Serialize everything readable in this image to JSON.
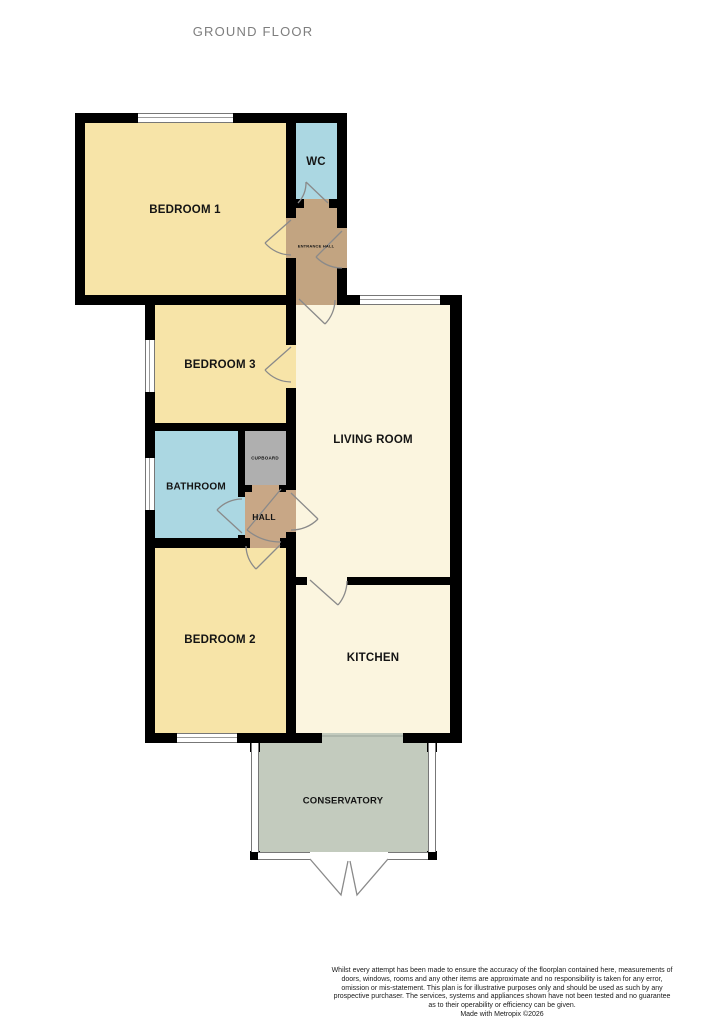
{
  "title": "GROUND FLOOR",
  "colors": {
    "bedroom": "#F7E4A8",
    "cream": "#FBF5DF",
    "wet": "#ABD7E2",
    "entrance": "#C2A481",
    "hall": "#C8A786",
    "cupboard": "#AFAFAF",
    "conservatory": "#C3CBBE",
    "wall": "#000000",
    "white": "#FFFFFF"
  },
  "rooms": {
    "bedroom1": {
      "label": "BEDROOM 1"
    },
    "wc": {
      "label": "WC"
    },
    "entrance_hall": {
      "label": "ENTRANCE HALL"
    },
    "bedroom3": {
      "label": "BEDROOM 3"
    },
    "living_room": {
      "label": "LIVING ROOM"
    },
    "bathroom": {
      "label": "BATHROOM"
    },
    "cupboard": {
      "label": "CUPBOARD"
    },
    "hall": {
      "label": "HALL"
    },
    "bedroom2": {
      "label": "BEDROOM 2"
    },
    "kitchen": {
      "label": "KITCHEN"
    },
    "conservatory": {
      "label": "CONSERVATORY"
    }
  },
  "footer": {
    "disclaimer": "Whilst every attempt has been made to ensure the accuracy of the floorplan contained here, measurements of doors, windows, rooms and any other items are approximate and no responsibility is taken for any error, omission or mis-statement. This plan is for illustrative purposes only and should be used as such by any prospective purchaser. The services, systems and appliances shown have not been tested and no guarantee as to their operability or efficiency can be given.",
    "credit": "Made with Metropix ©2026"
  }
}
